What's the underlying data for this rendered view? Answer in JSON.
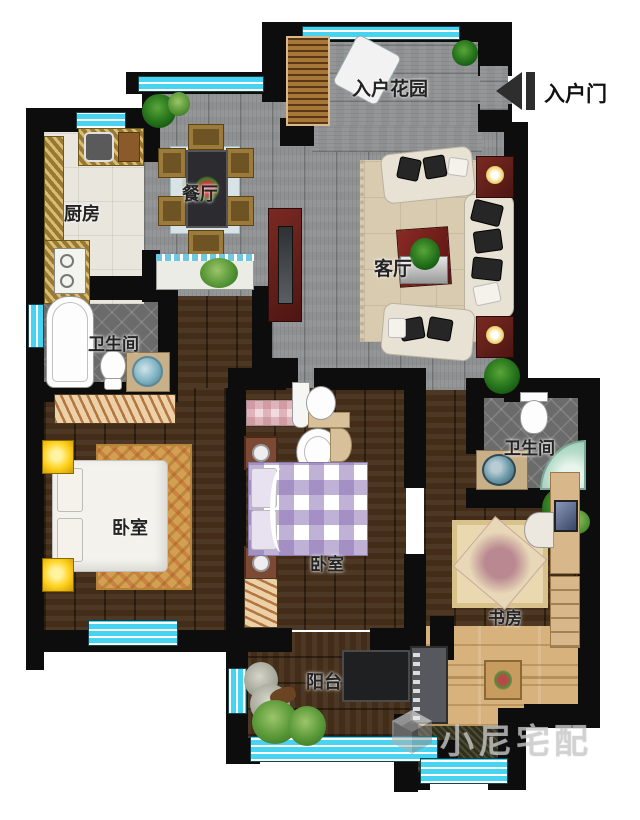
{
  "labels": {
    "entry_garden": "入户花园",
    "entry_door": "入户门",
    "dining": "餐厅",
    "kitchen": "厨房",
    "living": "客厅",
    "bathroom_left": "卫生间",
    "bathroom_right": "卫生间",
    "bedroom_master": "卧室",
    "bedroom_second": "卧室",
    "study": "书房",
    "balcony": "阳台",
    "watermark": "小尼宅配"
  },
  "colors": {
    "wall": "#0d0d0d",
    "window_cyan": "#46d4f0",
    "floor_gray": "#8f9092",
    "floor_dark_wood": "#432d18",
    "floor_light_wood": "#d7b27c",
    "counter_gold": "#b3954d",
    "accent_red_furniture": "#6e2420",
    "bed2_gingham": "#8c73b4",
    "nightstand_yellow": "#ffd21f"
  }
}
